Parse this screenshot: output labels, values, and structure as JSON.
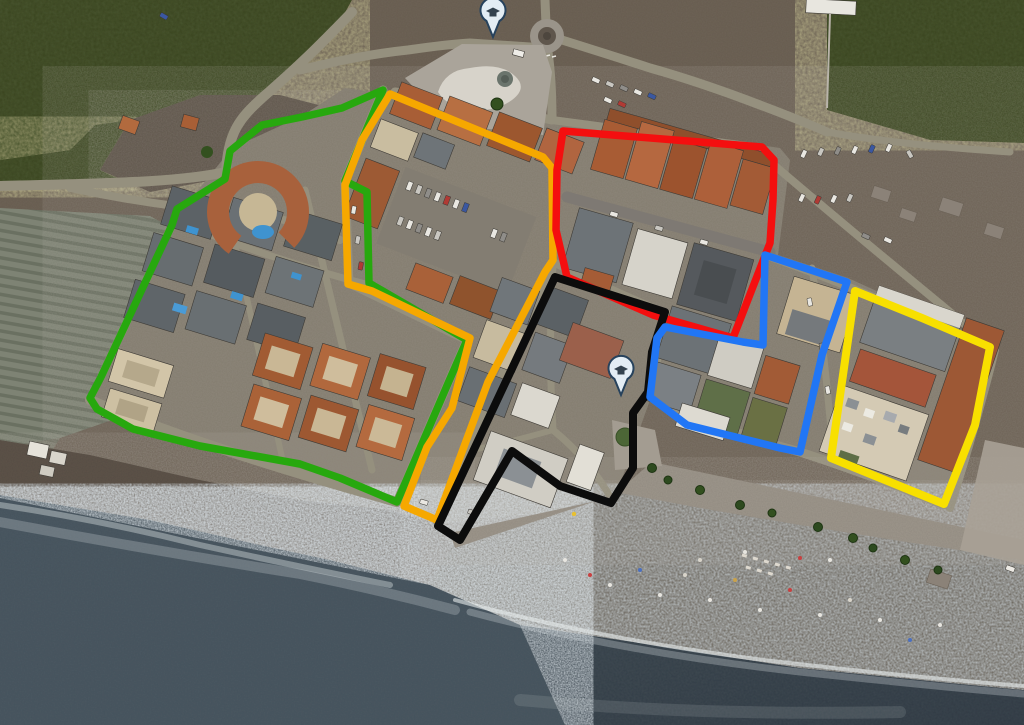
{
  "map": {
    "kind": "satellite-aerial-view",
    "zones": [
      {
        "id": "green",
        "stroke": "#27a80e",
        "stroke_width": 7.5,
        "points": "383,90 345,181 367,192 369,283 467,340 449,381 397,502 340,478 300,464 200,446 133,429 97,409 90,398 101,377 172,225 177,209 225,179 230,151 262,125 302,117 342,108"
      },
      {
        "id": "orange",
        "stroke": "#f6a800",
        "stroke_width": 7.5,
        "points": "390,94 543,157 552,168 553,260 545,272 488,382 462,452 437,520 404,506 427,447 452,408 470,338 372,291 348,284 345,185 362,140"
      },
      {
        "id": "red",
        "stroke": "#f40f0f",
        "stroke_width": 7.5,
        "points": "563,131 762,147 774,160 773,200 770,243 733,338 653,315 567,277 556,230 557,170"
      },
      {
        "id": "black",
        "stroke": "#0c0c0c",
        "stroke_width": 8,
        "points": "555,277 665,312 652,352 648,392 633,413 633,468 611,503 560,486 512,451 460,540 438,526"
      },
      {
        "id": "blue",
        "stroke": "#2176f5",
        "stroke_width": 7.5,
        "points": "765,255 847,282 822,355 800,452 780,448 687,425 650,397 657,338 665,327 743,342 763,345"
      },
      {
        "id": "yellow",
        "stroke": "#f8e000",
        "stroke_width": 8,
        "points": "855,291 922,318 990,347 975,425 944,504 885,480 831,458 843,375"
      }
    ],
    "markers": [
      {
        "id": "pin-north",
        "x": 493,
        "y": 13,
        "fill": "#e3edf4",
        "border": "#27425c",
        "glyph": "#33424e"
      },
      {
        "id": "pin-plaza",
        "x": 621,
        "y": 371,
        "fill": "#e3edf4",
        "border": "#27425c",
        "glyph": "#33424e"
      }
    ]
  }
}
